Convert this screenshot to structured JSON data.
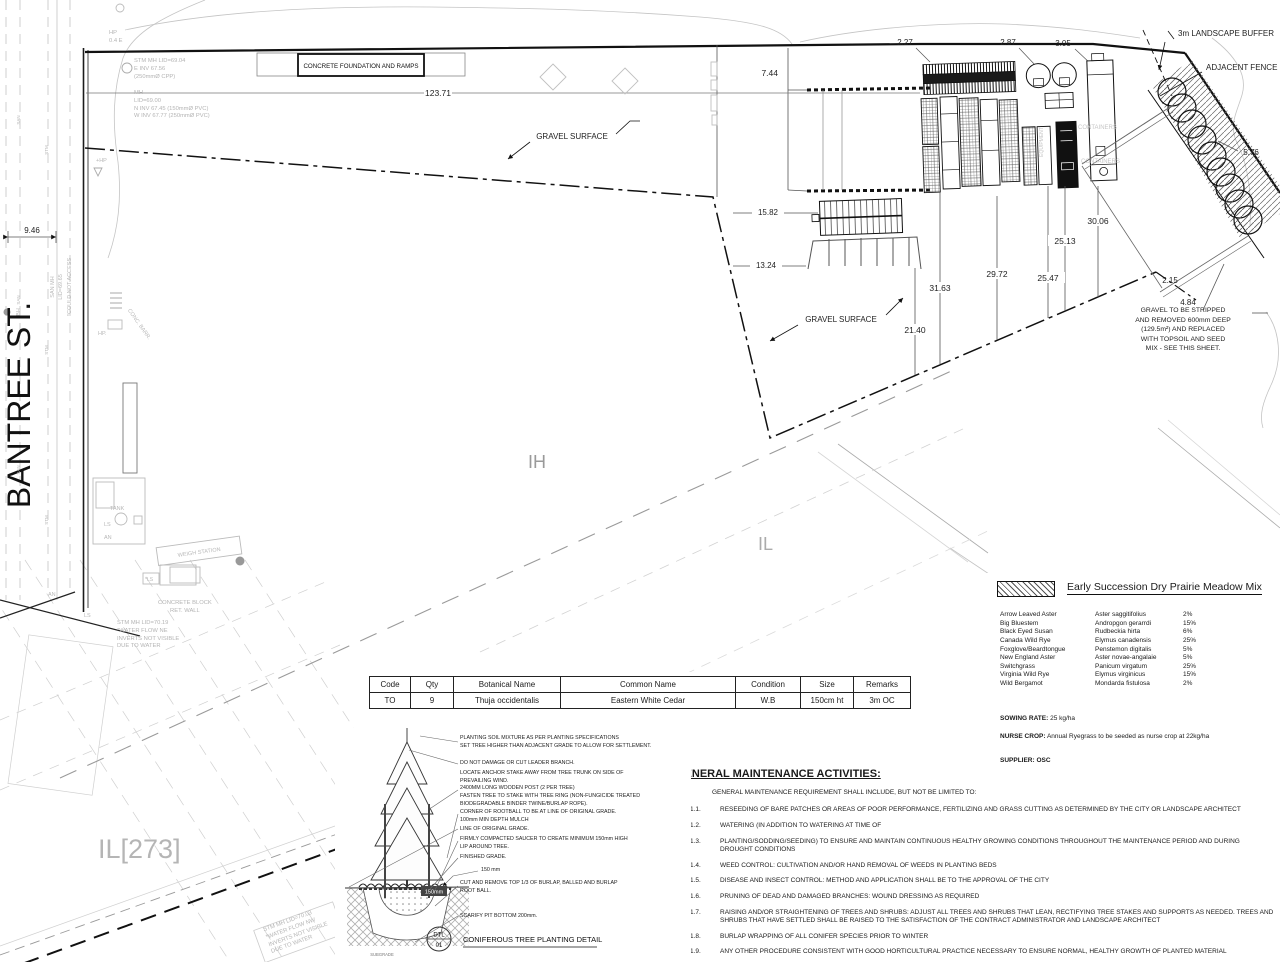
{
  "sheet": {
    "street_name": "BANTREE ST."
  },
  "zones": {
    "ih": "IH",
    "il": "IL",
    "il273": "IL[273]"
  },
  "dims": {
    "yard_width": "123.71",
    "street_width": "9.46",
    "offset_744": "7.44",
    "d227": "2.27",
    "d287": "2.87",
    "d305": "3.05",
    "d576": "5.76",
    "d1582": "15.82",
    "d1324": "13.24",
    "d3163": "31.63",
    "d2972": "29.72",
    "d2547": "25.47",
    "d2513": "25.13",
    "d3006": "30.06",
    "d2140": "21.40",
    "d215": "2.15",
    "d484": "4.84"
  },
  "annotations": {
    "landscape_buffer": "3m LANDSCAPE BUFFER",
    "adjacent_fence": "ADJACENT FENCE",
    "concrete_foundation": "CONCRETE FOUNDATION AND RAMPS",
    "gravel_surface": "GRAVEL SURFACE",
    "gravel_note": "GRAVEL TO BE STRIPPED\nAND REMOVED 600mm DEEP\n(129.5m²) AND REPLACED\nWITH TOPSOIL AND SEED\nMIX - SEE THIS SHEET."
  },
  "survey": {
    "stm_mh_top": "STM MH LID=69.04\nE INV 67.56\n(250mmØ CPP)",
    "mh_top": "MH\nLID=69.00\nN INV 67.45 (150mmØ PVC)\nW INV 67.77 (250mmØ PVC)",
    "hp_04": "HP\n0.4 E",
    "hp_plus": "+HP",
    "hp_dot": "HP.",
    "san_mh_note": "SAN MH",
    "san_lid": "LID=69.65",
    "could_not_access": "*COULD NOT ACCESS",
    "bh": "BH",
    "conc_barr": "CONC. BARR.",
    "weigh_station": "WEIGH STATION",
    "tank": "TANK",
    "ls": "LS",
    "an": "AN",
    "ls_star": "*LS",
    "concrete_block": "CONCRETE BLOCK\nRET. WALL",
    "stm_mh_ne": "STM MH LID=70.19\n*WATER FLOW NE\nINVERTS NOT VISIBLE\nDUE TO WATER",
    "stm_mh_nw": "STM MH LID=70.03\n*WATER FLOW NW\nINVERTS NOT VISIBLE\nDUE TO WATER",
    "containers": "CONTAINERS",
    "equipment": "EQUIPMENT",
    "san": "SAN",
    "stm": "STM"
  },
  "plant_table": {
    "headers": [
      "Code",
      "Qty",
      "Botanical Name",
      "Common Name",
      "Condition",
      "Size",
      "Remarks"
    ],
    "row": {
      "code": "TO",
      "qty": "9",
      "botanical": "Thuja occidentalis",
      "common": "Eastern White Cedar",
      "condition": "W.B",
      "size": "150cm ht",
      "remarks": "3m OC"
    }
  },
  "seed_mix": {
    "title": "Early Succession Dry Prairie Meadow Mix",
    "species": [
      {
        "common": "Arrow Leaved Aster",
        "botanical": "Aster saggitifolius",
        "pct": "2%"
      },
      {
        "common": "Big Bluestem",
        "botanical": "Andropgon gerarrdi",
        "pct": "15%"
      },
      {
        "common": "Black Eyed Susan",
        "botanical": "Rudbeckia hirta",
        "pct": "6%"
      },
      {
        "common": "Canada Wild Rye",
        "botanical": "Elymus canadensis",
        "pct": "25%"
      },
      {
        "common": "Foxglove/Beardtongue",
        "botanical": "Penstemon digitalis",
        "pct": "5%"
      },
      {
        "common": "New England Aster",
        "botanical": "Aster novae-angalaie",
        "pct": "5%"
      },
      {
        "common": "Switchgrass",
        "botanical": "Panicum virgatum",
        "pct": "25%"
      },
      {
        "common": "Virginia Wild Rye",
        "botanical": "Elymus virginicus",
        "pct": "15%"
      },
      {
        "common": "Wild Bergamot",
        "botanical": "Mondarda fistulosa",
        "pct": "2%"
      }
    ],
    "sowing_label": "SOWING RATE:",
    "sowing_value": "25 kg/ha",
    "nurse_label": "NURSE CROP:",
    "nurse_value": "Annual Ryegrass to be seeded as nurse crop at 22kg/ha",
    "supplier_label": "SUPPLIER:",
    "supplier_value": "OSC"
  },
  "maintenance": {
    "title": "GENERAL MAINTENANCE ACTIVITIES:",
    "items": [
      {
        "num": "1.",
        "text": "GENERAL MAINTENANCE REQUIREMENT SHALL INCLUDE, BUT NOT BE LIMITED TO:"
      },
      {
        "num": "1.1.",
        "text": "RESEEDING OF BARE PATCHES OR AREAS OF POOR PERFORMANCE, FERTILIZING AND GRASS CUTTING AS DETERMINED BY THE CITY OR LANDSCAPE ARCHITECT"
      },
      {
        "num": "1.2.",
        "text": "WATERING (IN ADDITION TO WATERING AT TIME OF"
      },
      {
        "num": "1.3.",
        "text": "PLANTING/SODDING/SEEDING) TO ENSURE AND MAINTAIN CONTINUOUS HEALTHY GROWING CONDITIONS THROUGHOUT THE MAINTENANCE PERIOD AND DURING DROUGHT CONDITIONS"
      },
      {
        "num": "1.4.",
        "text": "WEED CONTROL: CULTIVATION AND/OR HAND REMOVAL OF WEEDS IN PLANTING BEDS"
      },
      {
        "num": "1.5.",
        "text": "DISEASE AND INSECT CONTROL: METHOD AND APPLICATION SHALL BE TO THE APPROVAL OF THE CITY"
      },
      {
        "num": "1.6.",
        "text": "PRUNING OF DEAD AND DAMAGED BRANCHES: WOUND DRESSING AS REQUIRED"
      },
      {
        "num": "1.7.",
        "text": "RAISING AND/OR STRAIGHTENING OF TREES AND SHRUBS: ADJUST ALL TREES AND SHRUBS THAT LEAN, RECTIFYING TREE STAKES AND SUPPORTS AS NEEDED. TREES AND SHRUBS THAT HAVE SETTLED SHALL BE RAISED TO THE SATISFACTION OF THE CONTRACT ADMINISTRATOR AND LANDSCAPE ARCHITECT"
      },
      {
        "num": "1.8.",
        "text": "BURLAP WRAPPING OF ALL CONIFER SPECIES PRIOR TO WINTER"
      },
      {
        "num": "1.9.",
        "text": "ANY OTHER PROCEDURE CONSISTENT WITH GOOD HORTICULTURAL PRACTICE NECESSARY TO ENSURE NORMAL, HEALTHY GROWTH OF PLANTED MATERIAL"
      },
      {
        "num": "1.10.",
        "text": "MONITOR TREE GROWTH AND ADJUST ARBOR TIES AS REQUIRED TO PREVENT GIRDLING. REMOVE TREE STAKES AND TIES AFTER ONE (1) GROWING SEASON."
      }
    ]
  },
  "detail": {
    "callouts": [
      "PLANTING SOIL MIXTURE AS PER PLANTING SPECIFICATIONS\nSET TREE HIGHER THAN ADJACENT GRADE TO ALLOW FOR SETTLEMENT.",
      "DO NOT DAMAGE OR CUT LEADER BRANCH.",
      "LOCATE ANCHOR STAKE AWAY FROM TREE TRUNK ON SIDE OF\nPREVAILING WIND.\n2400MM LONG WOODEN POST  (2 PER TREE)\nFASTEN TREE TO STAKE WITH TREE RING (NON-FUNGICIDE TREATED\nBIODEGRADABLE BINDER TWINE/BURLAP ROPE).",
      "CORNER OF ROOTBALL TO BE AT LINE OF ORIGINAL GRADE.\n100mm MIN DEPTH MULCH",
      "LINE OF ORIGINAL GRADE.",
      "FIRMLY COMPACTED SAUCER TO CREATE MINIMUM 150mm HIGH\nLIP AROUND TREE.",
      "FINISHED GRADE.",
      "150 mm",
      "CUT AND REMOVE TOP 1/3 OF BURLAP, BALLED AND BURLAP\nROOT BALL.",
      "SCARIFY PIT BOTTOM 200mm."
    ],
    "ball_label": "150mm",
    "subgrade": "SUBGRADE",
    "tag_line1": "DTL",
    "tag_line2": "01",
    "title": "CONIFEROUS TREE PLANTING DETAIL"
  }
}
